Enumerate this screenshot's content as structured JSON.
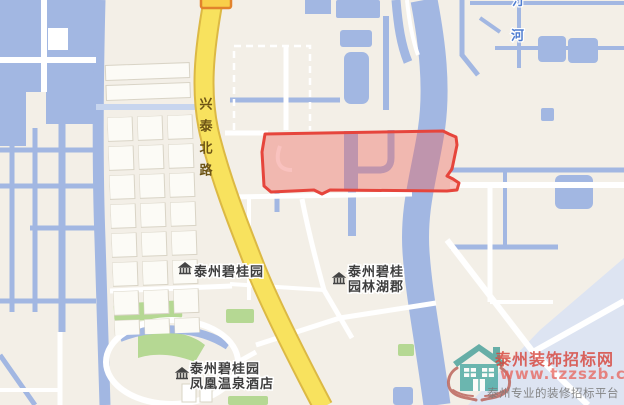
{
  "map": {
    "road_label": "兴泰北路",
    "river_label_partial": "汀",
    "river_label": "河",
    "pois": {
      "estate1": "泰州碧桂园",
      "estate2_line1": "泰州碧桂",
      "estate2_line2": "园林湖郡",
      "hotel_line1": "泰州碧桂园",
      "hotel_line2": "凤凰温泉酒店"
    }
  },
  "highlight": {
    "stroke": "#e6453c",
    "fill": "rgba(240,95,88,0.38)"
  },
  "watermark": {
    "site_name": "泰州装饰招标网",
    "site_url": "www.tzzszb.com",
    "tagline": "泰州专业的装修招标平台"
  },
  "colors": {
    "water": "#a2b7e2",
    "land": "#f3efe7",
    "road_major_fill": "#f8e25e",
    "road_major_casing": "#dcb944",
    "park_green": "#b5d893",
    "poi_icon": "#454545"
  }
}
